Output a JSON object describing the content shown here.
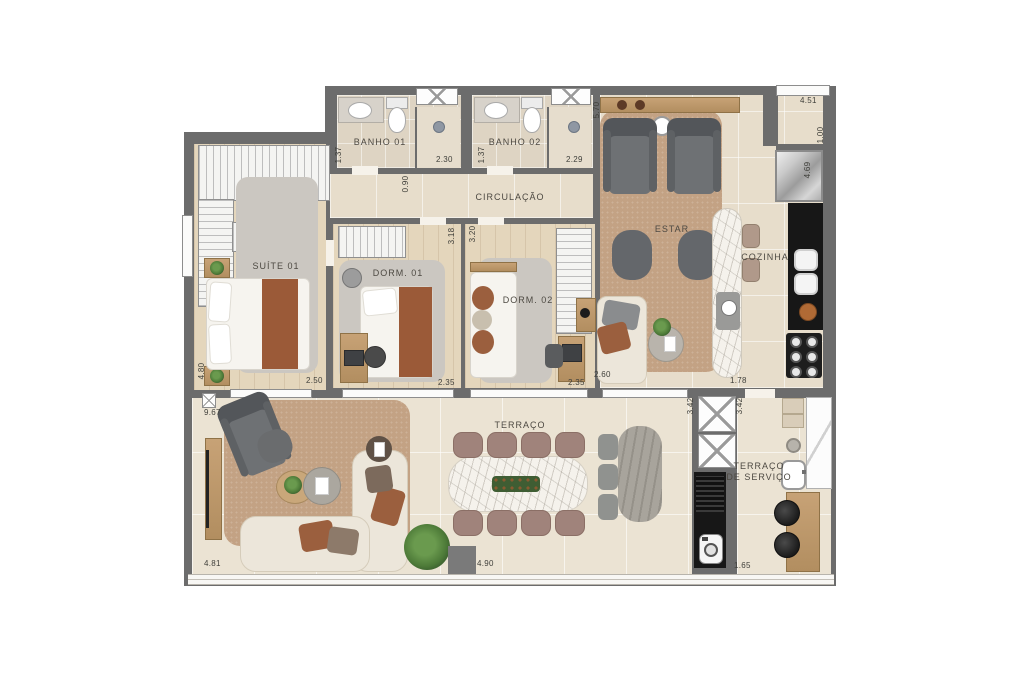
{
  "palette": {
    "wall": "#6c6c6c",
    "floor_tile": "#e7ddcb",
    "floor_wood": "#e4d6bc",
    "terrace_tile": "#ebe3d3",
    "rug_tan": "#c3a284",
    "rug_gray": "#cbc7c1",
    "accent_brown": "#9b5f3e",
    "counter_black": "#171717",
    "sofa_cream": "#ece6da"
  },
  "rooms": {
    "banho01": "BANHO 01",
    "banho02": "BANHO 02",
    "circulacao": "CIRCULAÇÃO",
    "suite01": "SUÍTE 01",
    "dorm01": "DORM. 01",
    "dorm02": "DORM. 02",
    "estar": "ESTAR",
    "cozinha": "COZINHA",
    "terraco": "TERRAÇO",
    "terraco_servico_l1": "TERRAÇO",
    "terraco_servico_l2": "DE SERVIÇO"
  },
  "dims": {
    "banho01_w": "1.37",
    "banho01_d": "2.30",
    "banho02_w": "1.37",
    "banho02_d": "2.29",
    "circulacao_w": "0.90",
    "estar_h": "5.70",
    "top_right": "4.51",
    "recuo": "1.00",
    "cozinha_h": "4.69",
    "cozinha_w": "1.78",
    "suite_h": "4.80",
    "suite_w": "2.50",
    "dorm01_h": "3.18",
    "dorm01_w": "2.35",
    "dorm02_h": "3.20",
    "dorm02_w": "2.35",
    "estar_sofa": "2.60",
    "terraco_h": "9.67",
    "terraco_w1": "4.81",
    "terraco_w2": "4.90",
    "shaft_left": "3.42",
    "shaft_right": "3.42",
    "servico_w": "1.65"
  }
}
